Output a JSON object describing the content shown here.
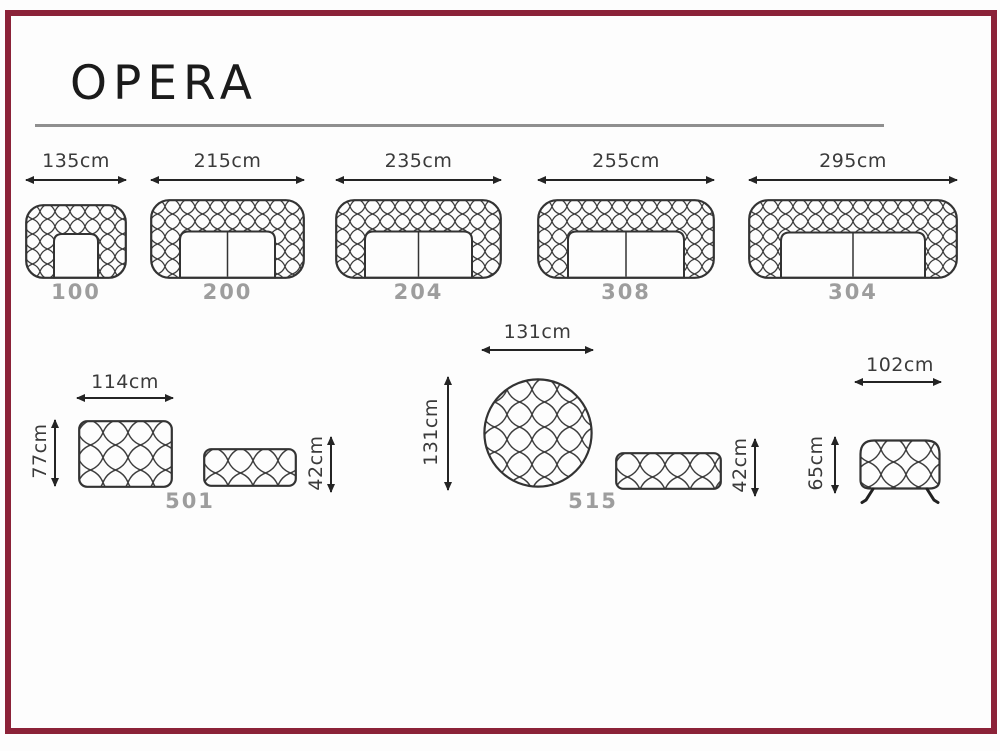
{
  "page": {
    "title": "OPERA"
  },
  "sofas": [
    {
      "width_label": "135cm",
      "model": "100"
    },
    {
      "width_label": "215cm",
      "model": "200"
    },
    {
      "width_label": "235cm",
      "model": "204"
    },
    {
      "width_label": "255cm",
      "model": "308"
    },
    {
      "width_label": "295cm",
      "model": "304"
    }
  ],
  "bottom_items": {
    "pouf_501": {
      "width_label": "114cm",
      "depth_label": "77cm",
      "model": "501"
    },
    "bench_42_left": {
      "height_label": "42cm"
    },
    "pouf_515": {
      "width_label": "131cm",
      "depth_label": "131cm",
      "model": "515"
    },
    "bench_42_right": {
      "height_label": "42cm"
    },
    "armchair_bench": {
      "width_label": "102cm",
      "height_label": "65cm"
    }
  },
  "colors": {
    "frame": "#8b2238",
    "drawing_line": "#333333",
    "dimension_text": "#3a3a3a",
    "model_text": "#9d9d9d",
    "divider_rule": "#8f8f8f"
  }
}
